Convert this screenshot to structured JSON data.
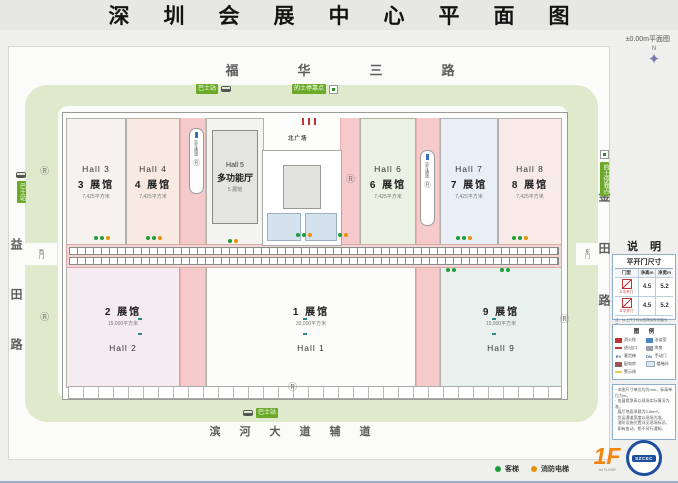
{
  "title": "深圳会展中心平面图",
  "plan_label": "±0.00m平面图",
  "compass": {
    "north": "N",
    "glyph": "✦"
  },
  "streets": {
    "top": "福华三路",
    "bottom": "滨河大道辅道",
    "left": "益田路",
    "right": "金田路"
  },
  "stops": {
    "bus": "巴士站",
    "taxi": "的士停靠点"
  },
  "gates": {
    "west": "西门",
    "east": "东门",
    "plaza": "北广场"
  },
  "halls": {
    "h3": {
      "en": "Hall 3",
      "cn": "3 展馆",
      "area": "7,425平方米"
    },
    "h4": {
      "en": "Hall 4",
      "cn": "4 展馆",
      "area": "7,425平方米"
    },
    "h5": {
      "en": "Hall 5",
      "cn": "多功能厅",
      "sub": "5 展馆"
    },
    "h6": {
      "en": "Hall 6",
      "cn": "6 展馆",
      "area": "7,425平方米"
    },
    "h7": {
      "en": "Hall 7",
      "cn": "7 展馆",
      "area": "7,425平方米"
    },
    "h8": {
      "en": "Hall 8",
      "cn": "8 展馆",
      "area": "7,425平方米"
    },
    "h2": {
      "cn": "2 展馆",
      "area": "15,000平方米",
      "en": "Hall 2"
    },
    "h1": {
      "cn": "1 展馆",
      "area": "30,000平方米",
      "en": "Hall 1"
    },
    "h9": {
      "cn": "9 展馆",
      "area": "15,000平方米",
      "en": "Hall 9"
    }
  },
  "markers": {
    "r": "Ⓡ",
    "corridor": "货车通道"
  },
  "colors": {
    "accent_green": "#6aaa28",
    "corridor_pink": "#f6caca",
    "elevator_green": "#1f9d3a",
    "fire_orange": "#e8920a",
    "floor_orange": "#f08511",
    "logo_blue": "#1e4f9e"
  },
  "panel": {
    "header": "说明",
    "door_table": {
      "title": "平开门尺寸",
      "col_type": "门型",
      "col_h": "净高m",
      "col_w": "净宽m",
      "rows": [
        {
          "type": "A 平开门",
          "h": "4.5",
          "w": "5.2"
        },
        {
          "type": "B 平开门",
          "h": "4.5",
          "w": "5.2"
        }
      ],
      "note": "注：以上尺寸均以现场实际测量为准。"
    },
    "legend": {
      "title": "图 例",
      "left": [
        {
          "label": "消火栓"
        },
        {
          "label": "进/出口"
        },
        {
          "label": "客货梯",
          "code": "EV"
        },
        {
          "label": "配电房"
        },
        {
          "label": "警示线"
        }
      ],
      "right": [
        {
          "label": "洽谈室"
        },
        {
          "label": "库房"
        },
        {
          "label": "手动门",
          "code": "DN"
        },
        {
          "label": "楼梯间"
        }
      ]
    },
    "notes": [
      "· 本图尺寸单位均为mm，标高单位为m。",
      "· 各展馆净高以现场实际情况为准。",
      "· 展厅地面承载为3.5t/m²。",
      "· 货运通道宽度以现场为准。",
      "· 消防设施位置详见现场标识。",
      "· 如有变动，恕不另行通知。"
    ]
  },
  "footer": {
    "passenger": "客梯",
    "fire": "消防电梯",
    "floor": "1F",
    "floor_sub": "1st FLOOR",
    "logo": "SZCEC"
  }
}
